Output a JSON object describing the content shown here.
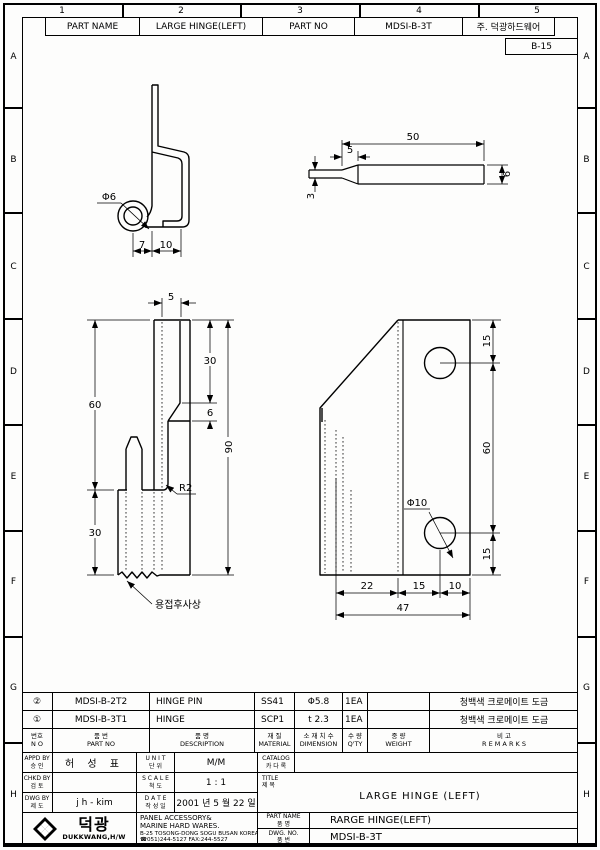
{
  "sheet": {
    "zone_columns": [
      "1",
      "2",
      "3",
      "4",
      "5"
    ],
    "zone_rows": [
      "A",
      "B",
      "C",
      "D",
      "E",
      "F",
      "G",
      "H"
    ],
    "ref_box": "B-15"
  },
  "header": {
    "part_name_label": "PART NAME",
    "part_name_value": "LARGE HINGE(LEFT)",
    "part_no_label": "PART NO",
    "part_no_value": "MDSI-B-3T",
    "company": "주. 덕광하드웨어"
  },
  "drawing": {
    "profile_view": {
      "dia": "Φ6",
      "d1": "7",
      "d2": "10"
    },
    "pin_view": {
      "len": "50",
      "taper": "5",
      "dia": "6",
      "tip": "3"
    },
    "front_view": {
      "w": "5",
      "top": "30",
      "bevel": "6",
      "upper": "60",
      "overall": "90",
      "lower": "30",
      "radius": "R2",
      "weld_note": "용접후사상"
    },
    "plate_view": {
      "top": "15",
      "mid": "60",
      "bottom": "15",
      "hole": "Φ10",
      "b1": "22",
      "b2": "15",
      "b3": "10",
      "total": "47"
    }
  },
  "parts_table": {
    "headers": {
      "no_kr": "번호",
      "no_en": "N O",
      "part_no_kr": "품       번",
      "part_no_en": "PART    NO",
      "desc_kr": "품       명",
      "desc_en": "DESCRIPTION",
      "material_kr": "재    질",
      "material_en": "MATERIAL",
      "dimension_kr": "소 재 치 수",
      "dimension_en": "DIMENSION",
      "qty_kr": "수 량",
      "qty_en": "Q'TY",
      "weight_kr": "중    량",
      "weight_en": "WEIGHT",
      "remarks_kr": "비        고",
      "remarks_en": "R E M A R K S"
    },
    "rows": [
      {
        "no": "②",
        "part_no": "MDSI-B-2T2",
        "description": "HINGE PIN",
        "material": "SS41",
        "dimension": "Φ5.8",
        "qty": "1EA",
        "weight": "",
        "remarks": "청백색 크로메이트 도금"
      },
      {
        "no": "①",
        "part_no": "MDSI-B-3T1",
        "description": "HINGE",
        "material": "SCP1",
        "dimension": "t 2.3",
        "qty": "1EA",
        "weight": "",
        "remarks": "청백색 크로메이트 도금"
      }
    ]
  },
  "title_block": {
    "appd_en": "APPD BY",
    "appd_kr": "승   인",
    "appd_value": "허 성 표",
    "chkd_en": "CHKD BY",
    "chkd_kr": "검   토",
    "chkd_value": "",
    "dwg_en": "DWG BY",
    "dwg_kr": "제   도",
    "dwg_value": "j h - kim",
    "unit_en": "U N I T",
    "unit_kr": "단   위",
    "unit_value": "M/M",
    "scale_en": "S C A L E",
    "scale_kr": "척   도",
    "scale_value": "1 : 1",
    "date_en": "D A T E",
    "date_kr": "작 성 일",
    "date_value": "2001 년 5 월 22 일",
    "catalog_en": "CATALOG",
    "catalog_kr": "카 다 록",
    "catalog_value": "",
    "title_en": "TITLE",
    "title_kr": "제 목",
    "title_value": "LARGE HINGE (LEFT)",
    "company_line1": "PANEL ACCESSORY&",
    "company_line2": "MARINE HARD WARES.",
    "company_addr": "B-25 TOSONG-DONG SOGU BUSAN KOREA",
    "company_tel": "☎051)244-5127 FAX:244-5527",
    "logo_kr": "덕광",
    "logo_en": "DUKKWANG,H/W",
    "part_name_en": "PART  NAME",
    "part_name_kr": "품   명",
    "part_name_value": "RARGE HINGE(LEFT)",
    "dwg_no_en": "DWG.   NO.",
    "dwg_no_kr": "품   번",
    "dwg_no_value": "MDSI-B-3T"
  }
}
